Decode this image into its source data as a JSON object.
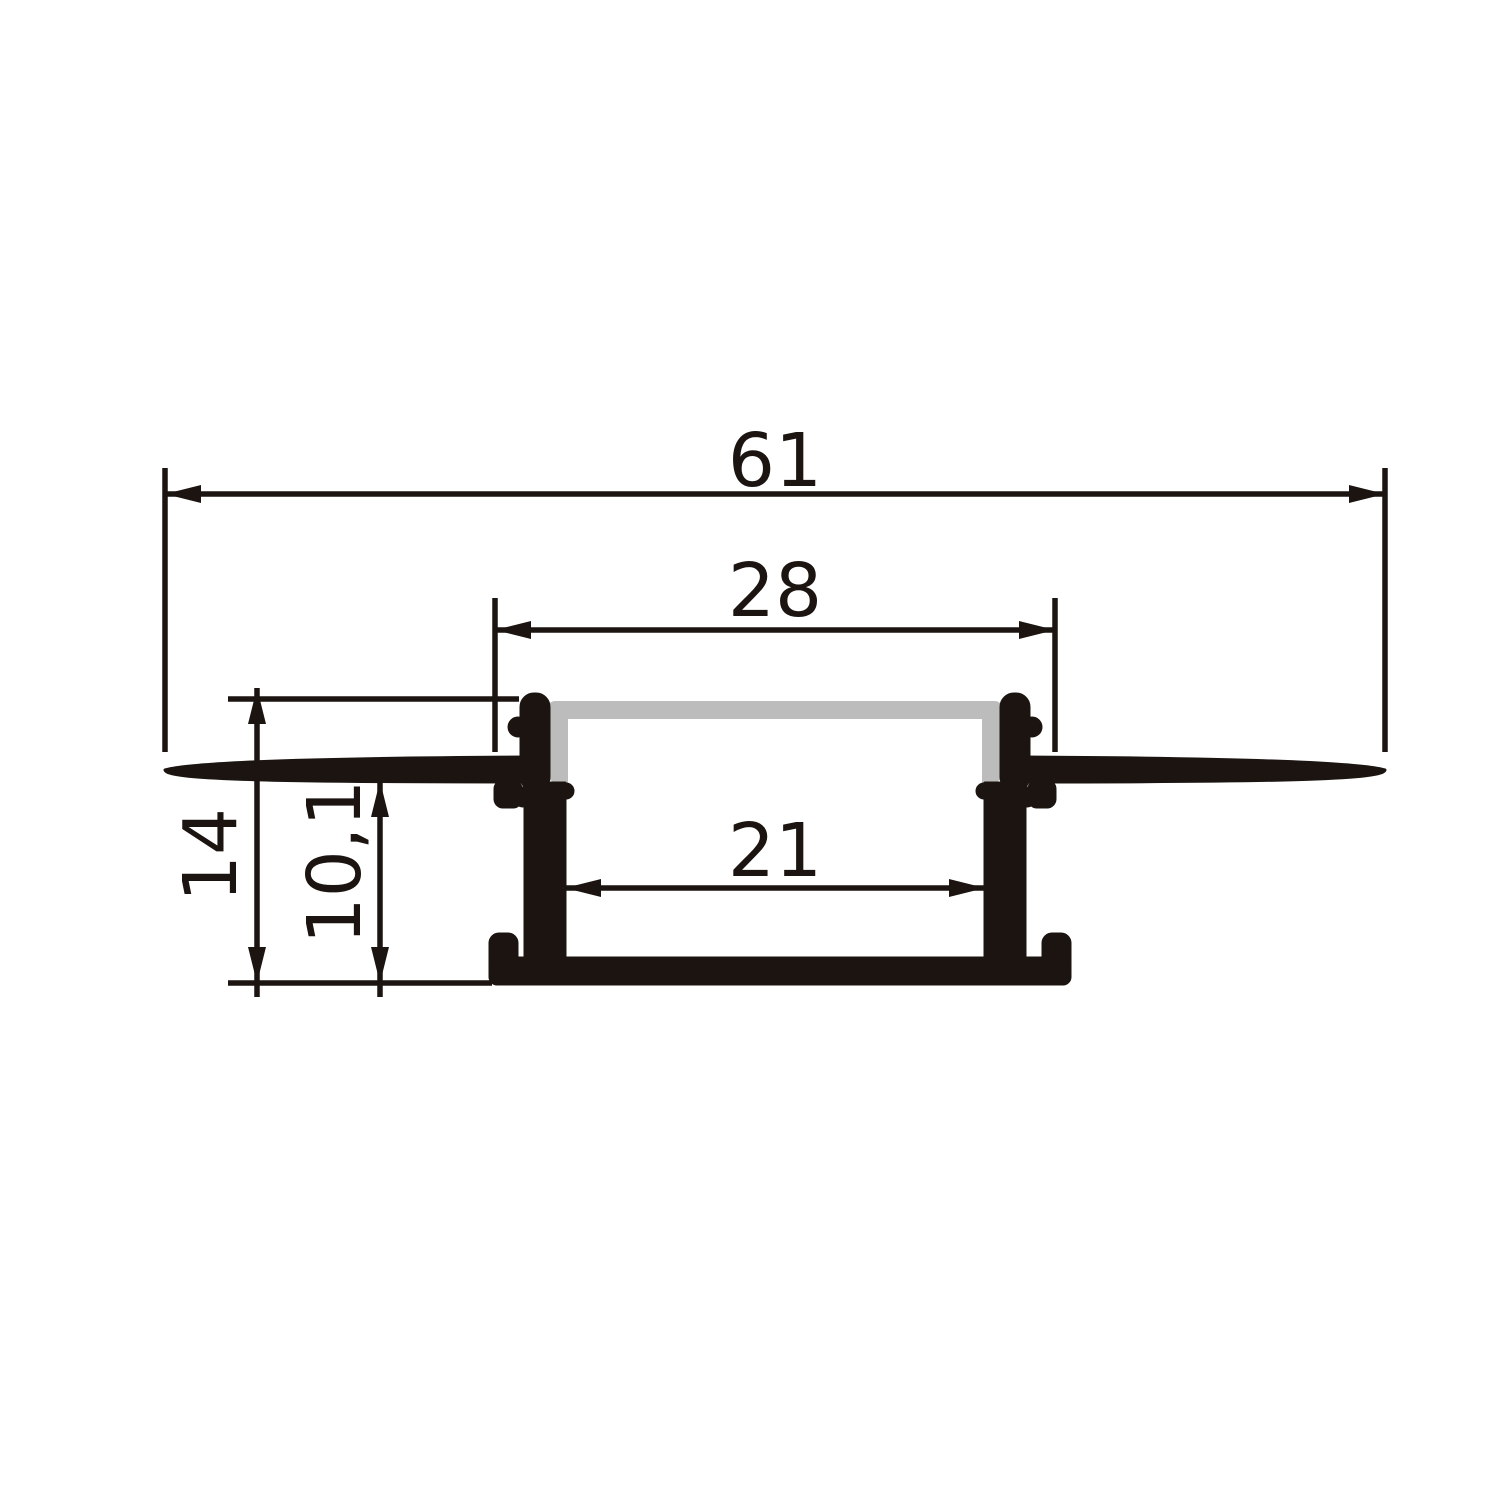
{
  "drawing": {
    "colors": {
      "ink": "#1b1410",
      "diffuser": "#bcbcbc",
      "background": "#ffffff"
    },
    "dimensions": {
      "overall_width": {
        "label": "61"
      },
      "opening_width": {
        "label": "28"
      },
      "inner_width": {
        "label": "21"
      },
      "overall_height": {
        "label": "14"
      },
      "inner_height": {
        "label": "10,1"
      }
    }
  }
}
